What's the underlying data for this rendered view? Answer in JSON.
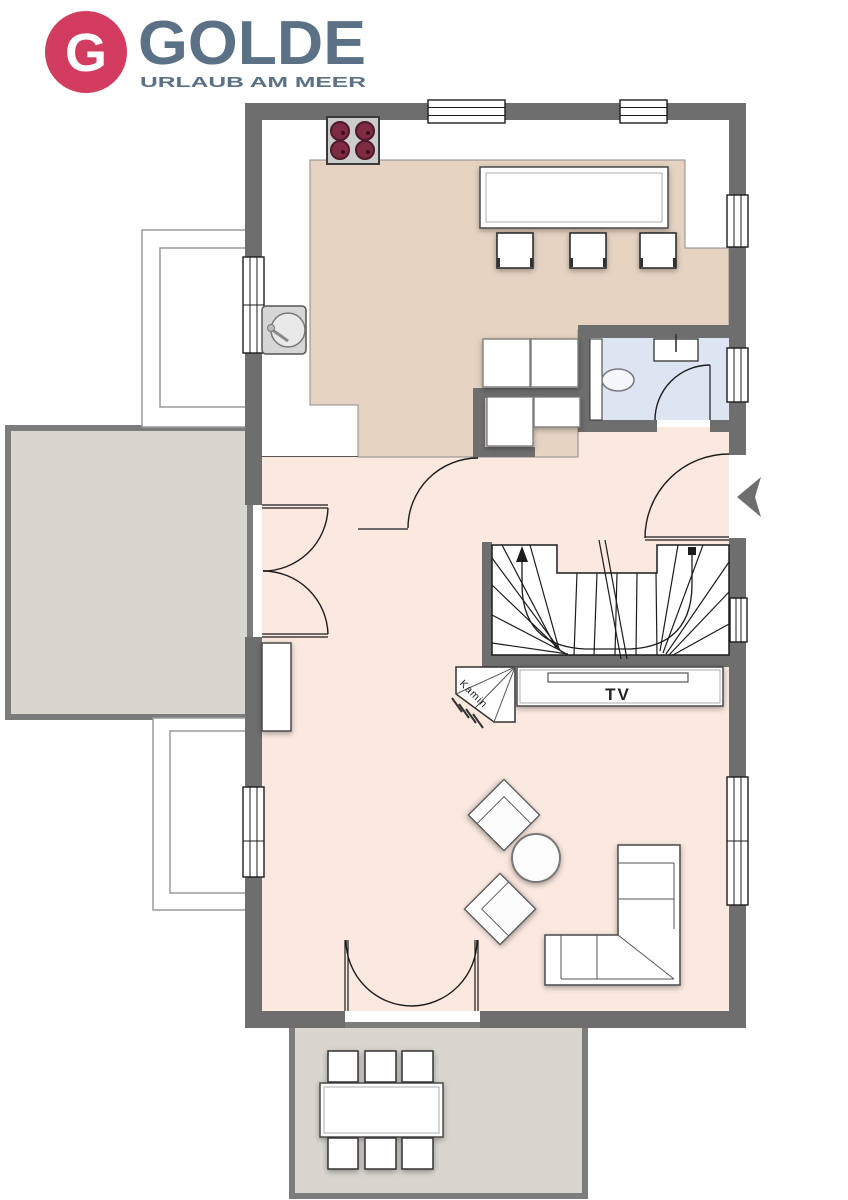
{
  "logo": {
    "monogram": "G",
    "brand": "GOLDE",
    "tagline": "URLAUB AM MEER"
  },
  "floorplan": {
    "labels": {
      "tv": "TV",
      "fireplace": "Kamin"
    }
  },
  "colors": {
    "wall": "#6e6e6e",
    "floor_kitchen": "#e6d3c2",
    "floor_living": "#fbe9e0",
    "floor_bath": "#dde4f2",
    "terrace": "#d9d5cf",
    "terrace_border": "#7c7c7c",
    "counter": "#ffffff",
    "burner": "#7f2b42",
    "logo_red": "#d23c5e",
    "logo_slate": "#5b7186"
  }
}
